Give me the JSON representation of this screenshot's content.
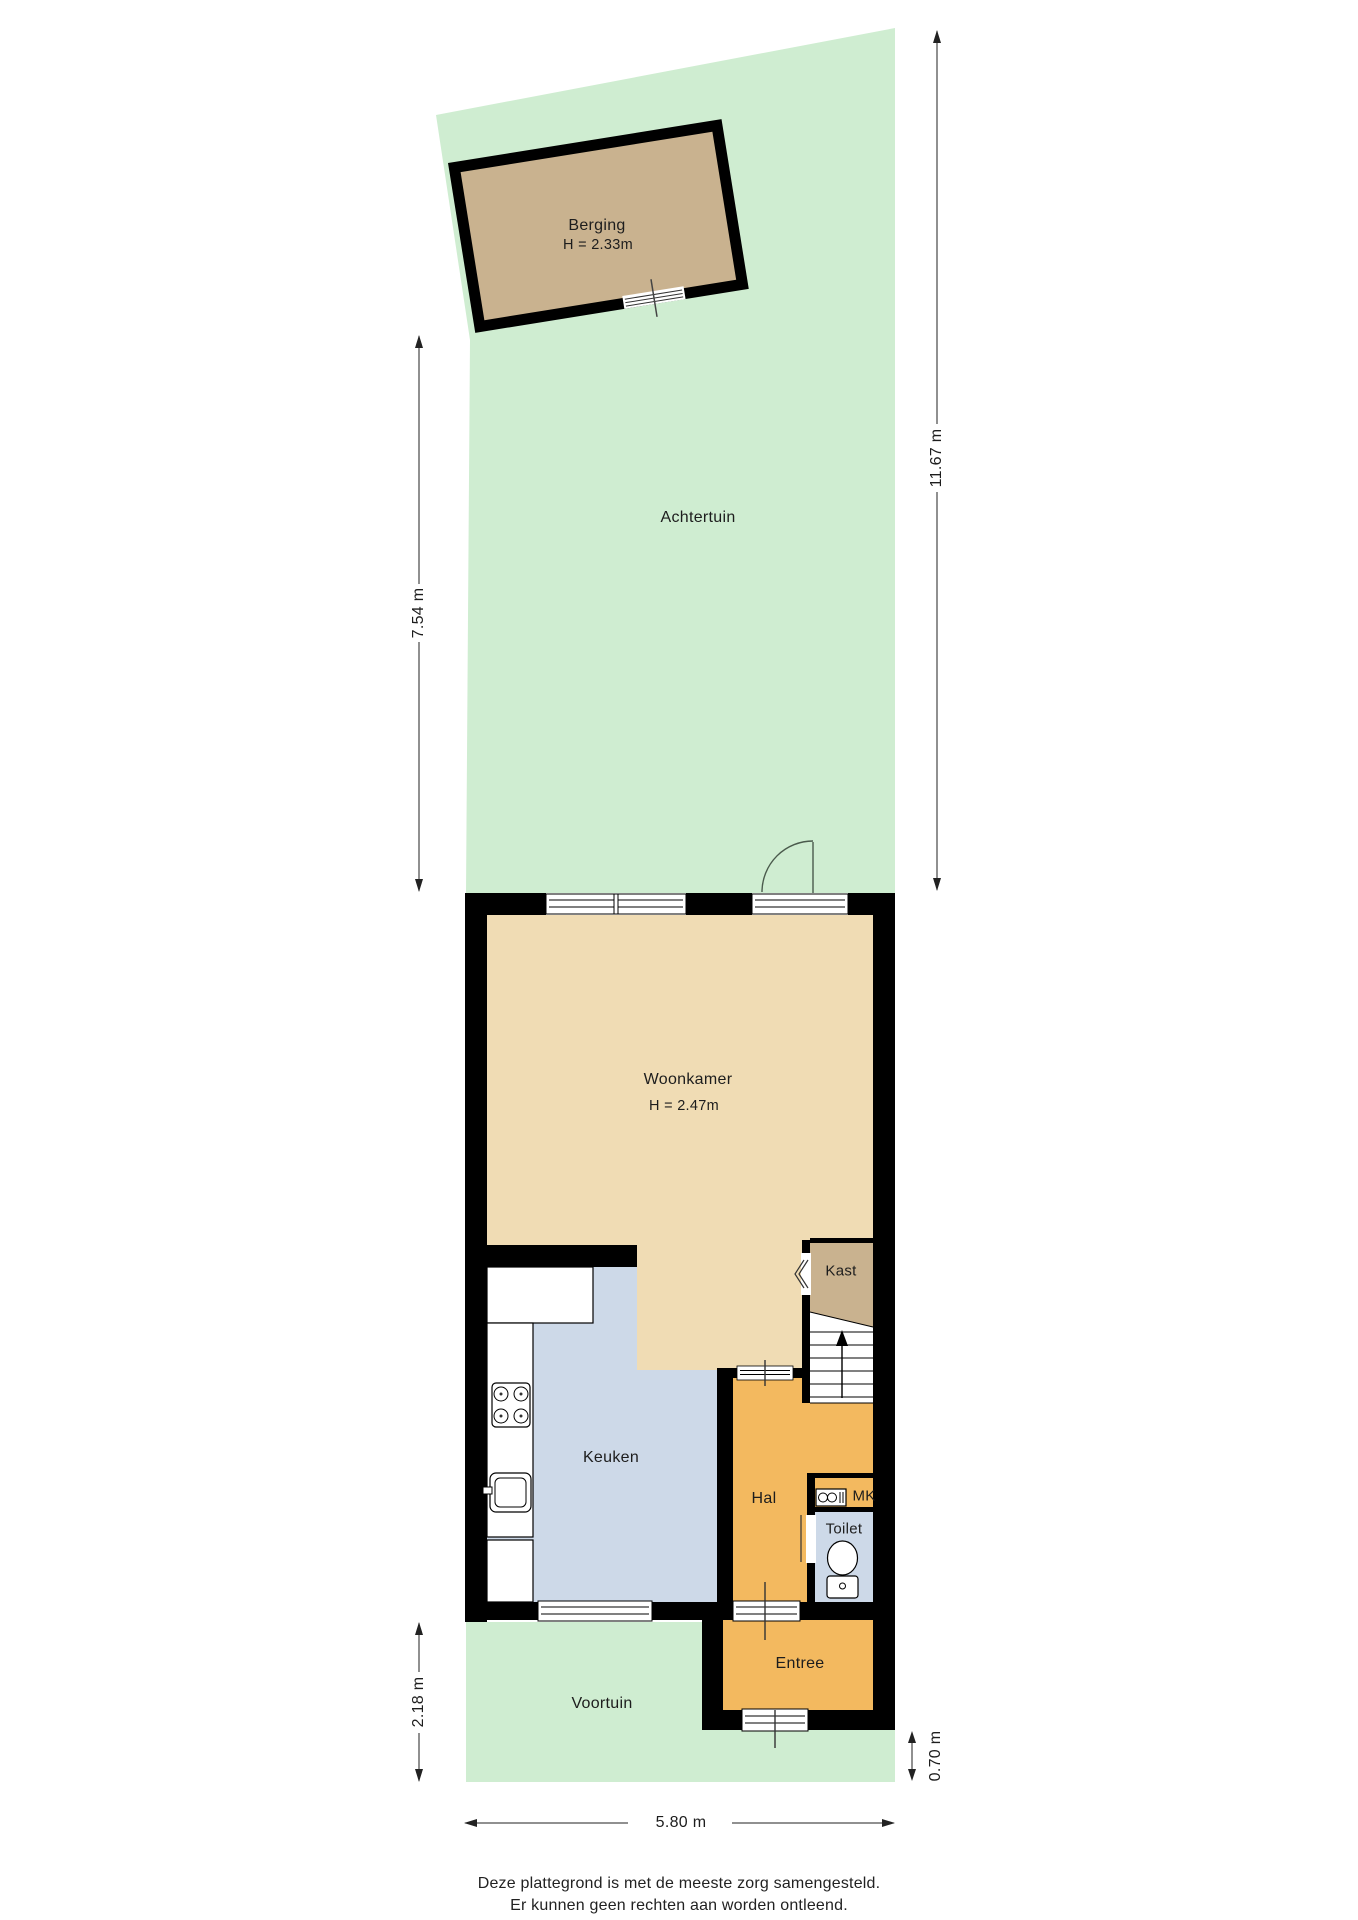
{
  "colors": {
    "garden": "#cfedd1",
    "floor_light": "#f0dcb4",
    "floor_dark": "#c9b28f",
    "floor_blue": "#cdd9e8",
    "floor_orange": "#f3b95f",
    "wall": "#000000",
    "white": "#ffffff"
  },
  "rooms": {
    "berging": {
      "label": "Berging",
      "height": "H = 2.33m"
    },
    "achtertuin": {
      "label": "Achtertuin"
    },
    "woonkamer": {
      "label": "Woonkamer",
      "height": "H = 2.47m"
    },
    "kast": {
      "label": "Kast"
    },
    "keuken": {
      "label": "Keuken"
    },
    "hal": {
      "label": "Hal"
    },
    "mk": {
      "label": "MK"
    },
    "toilet": {
      "label": "Toilet"
    },
    "entree": {
      "label": "Entree"
    },
    "voortuin": {
      "label": "Voortuin"
    }
  },
  "dimensions": {
    "garden_depth_left": "7.54 m",
    "total_depth_right": "11.67 m",
    "front_garden_depth": "2.18 m",
    "front_strip_depth": "0.70 m",
    "plot_width": "5.80 m"
  },
  "footer": {
    "line1": "Deze plattegrond is met de meeste zorg samengesteld.",
    "line2": "Er kunnen geen rechten aan worden ontleend."
  }
}
